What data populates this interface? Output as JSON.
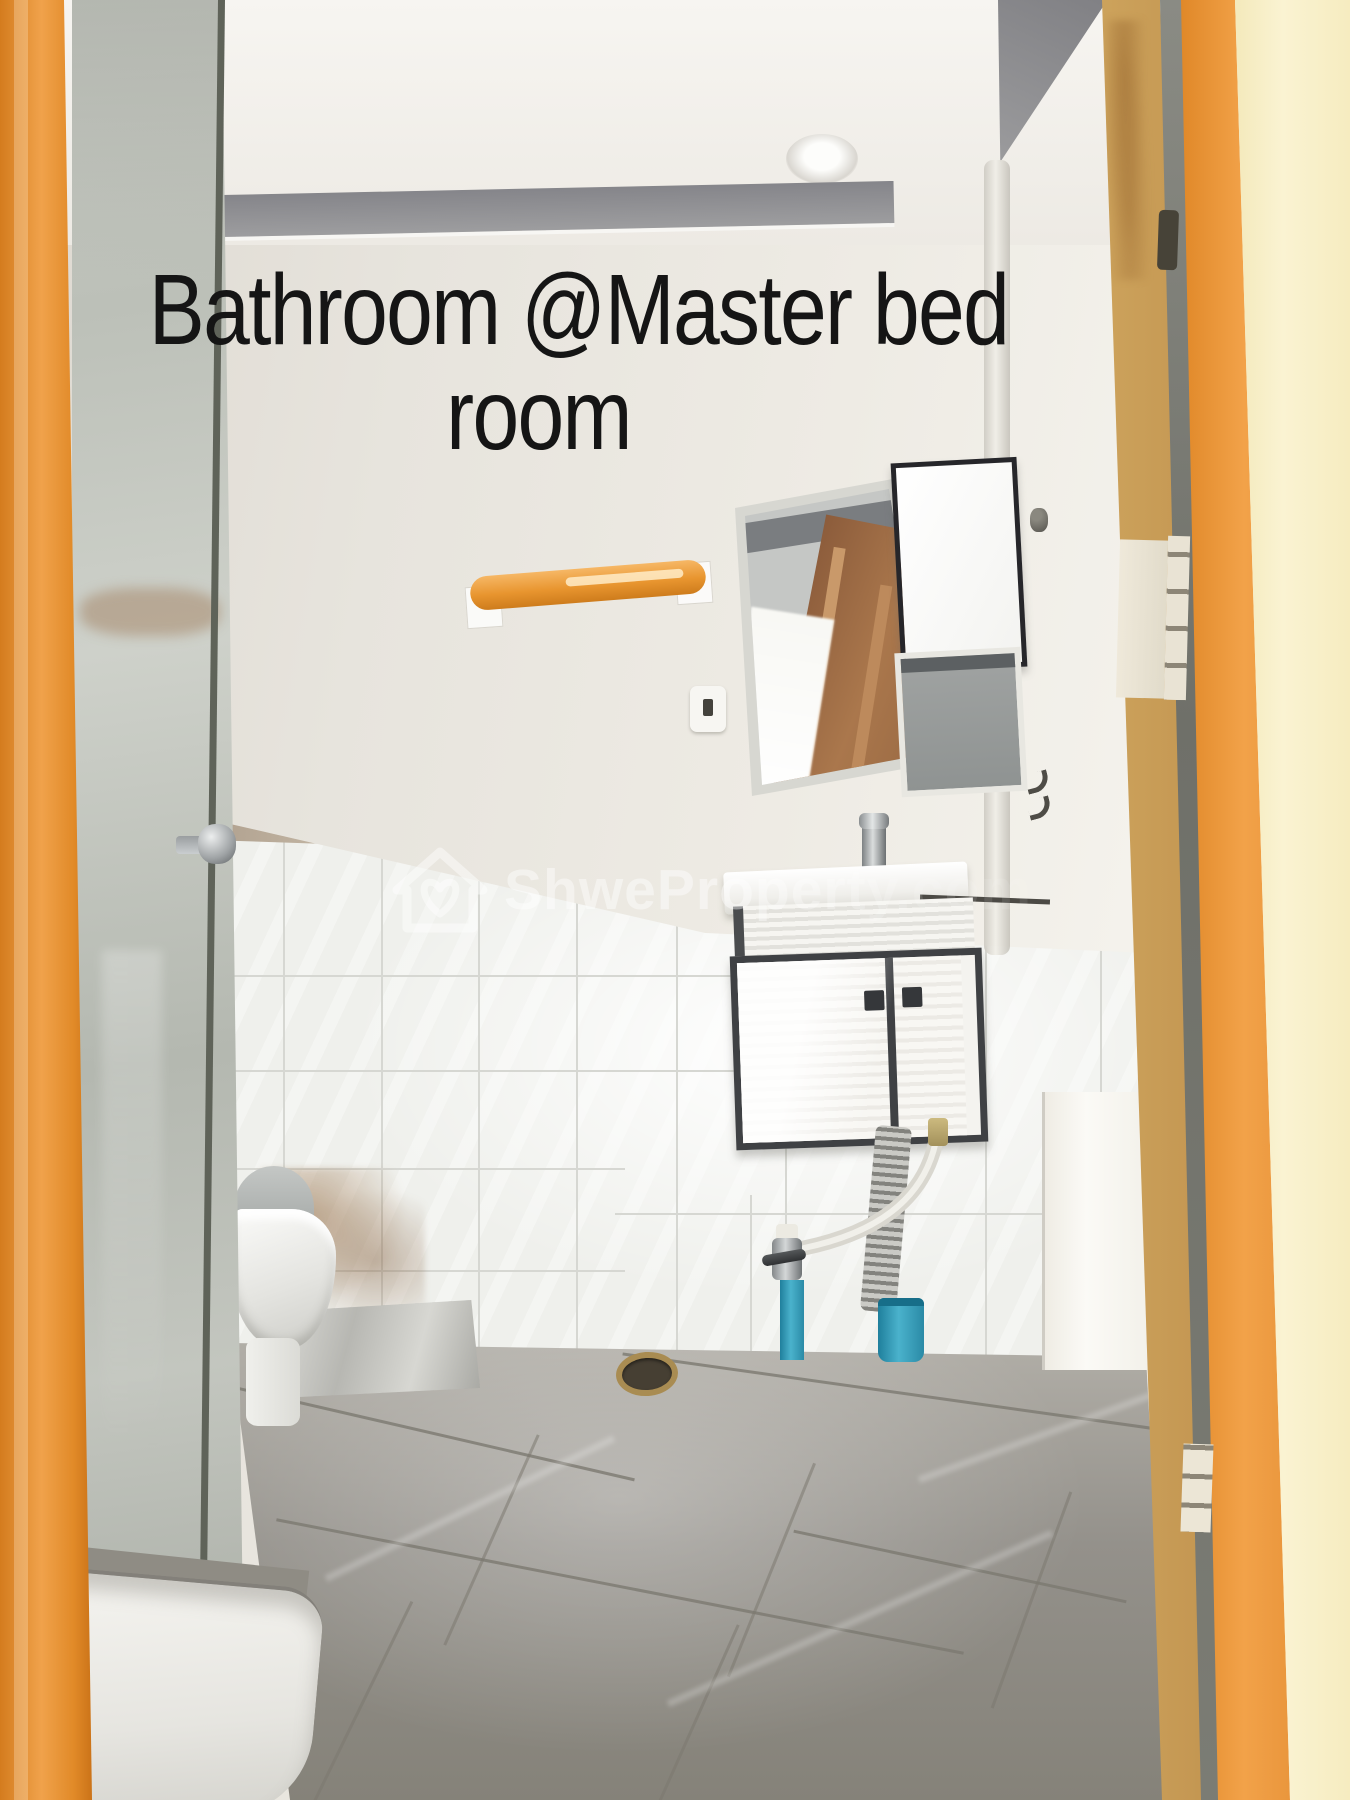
{
  "photo": {
    "caption_line1": "Bathroom @Master bed",
    "caption_line2": "room",
    "watermark": {
      "brand": "ShweProperty.com",
      "icon": "house-heart-icon"
    },
    "scene": {
      "description": "Bathroom at master bedroom: glass shower enclosure with chrome knob, toilet, orange towel bar, mirror reflecting a wooden door, wall cabinet panels, white floating vanity with chrome faucet, corrugated and blue water pipes, floor drain, gray tiled floor, white tiled lower wall, open orange wooden door at right"
    },
    "colors": {
      "left_frame_orange": "#f0a24b",
      "door_orange": "#f2a249",
      "door_pale": "#faf3d2",
      "frame_wood": "#cda35c",
      "wall_cream": "#e9e6df",
      "ceiling_gray": "#909092",
      "tile_white": "#eff0ec",
      "floor_gray": "#979289",
      "pipe_blue": "#4ab2cc",
      "towel_bar_orange": "#e8952f",
      "caption_black": "#151515",
      "watermark_white": "rgba(255,255,255,0.45)"
    }
  }
}
